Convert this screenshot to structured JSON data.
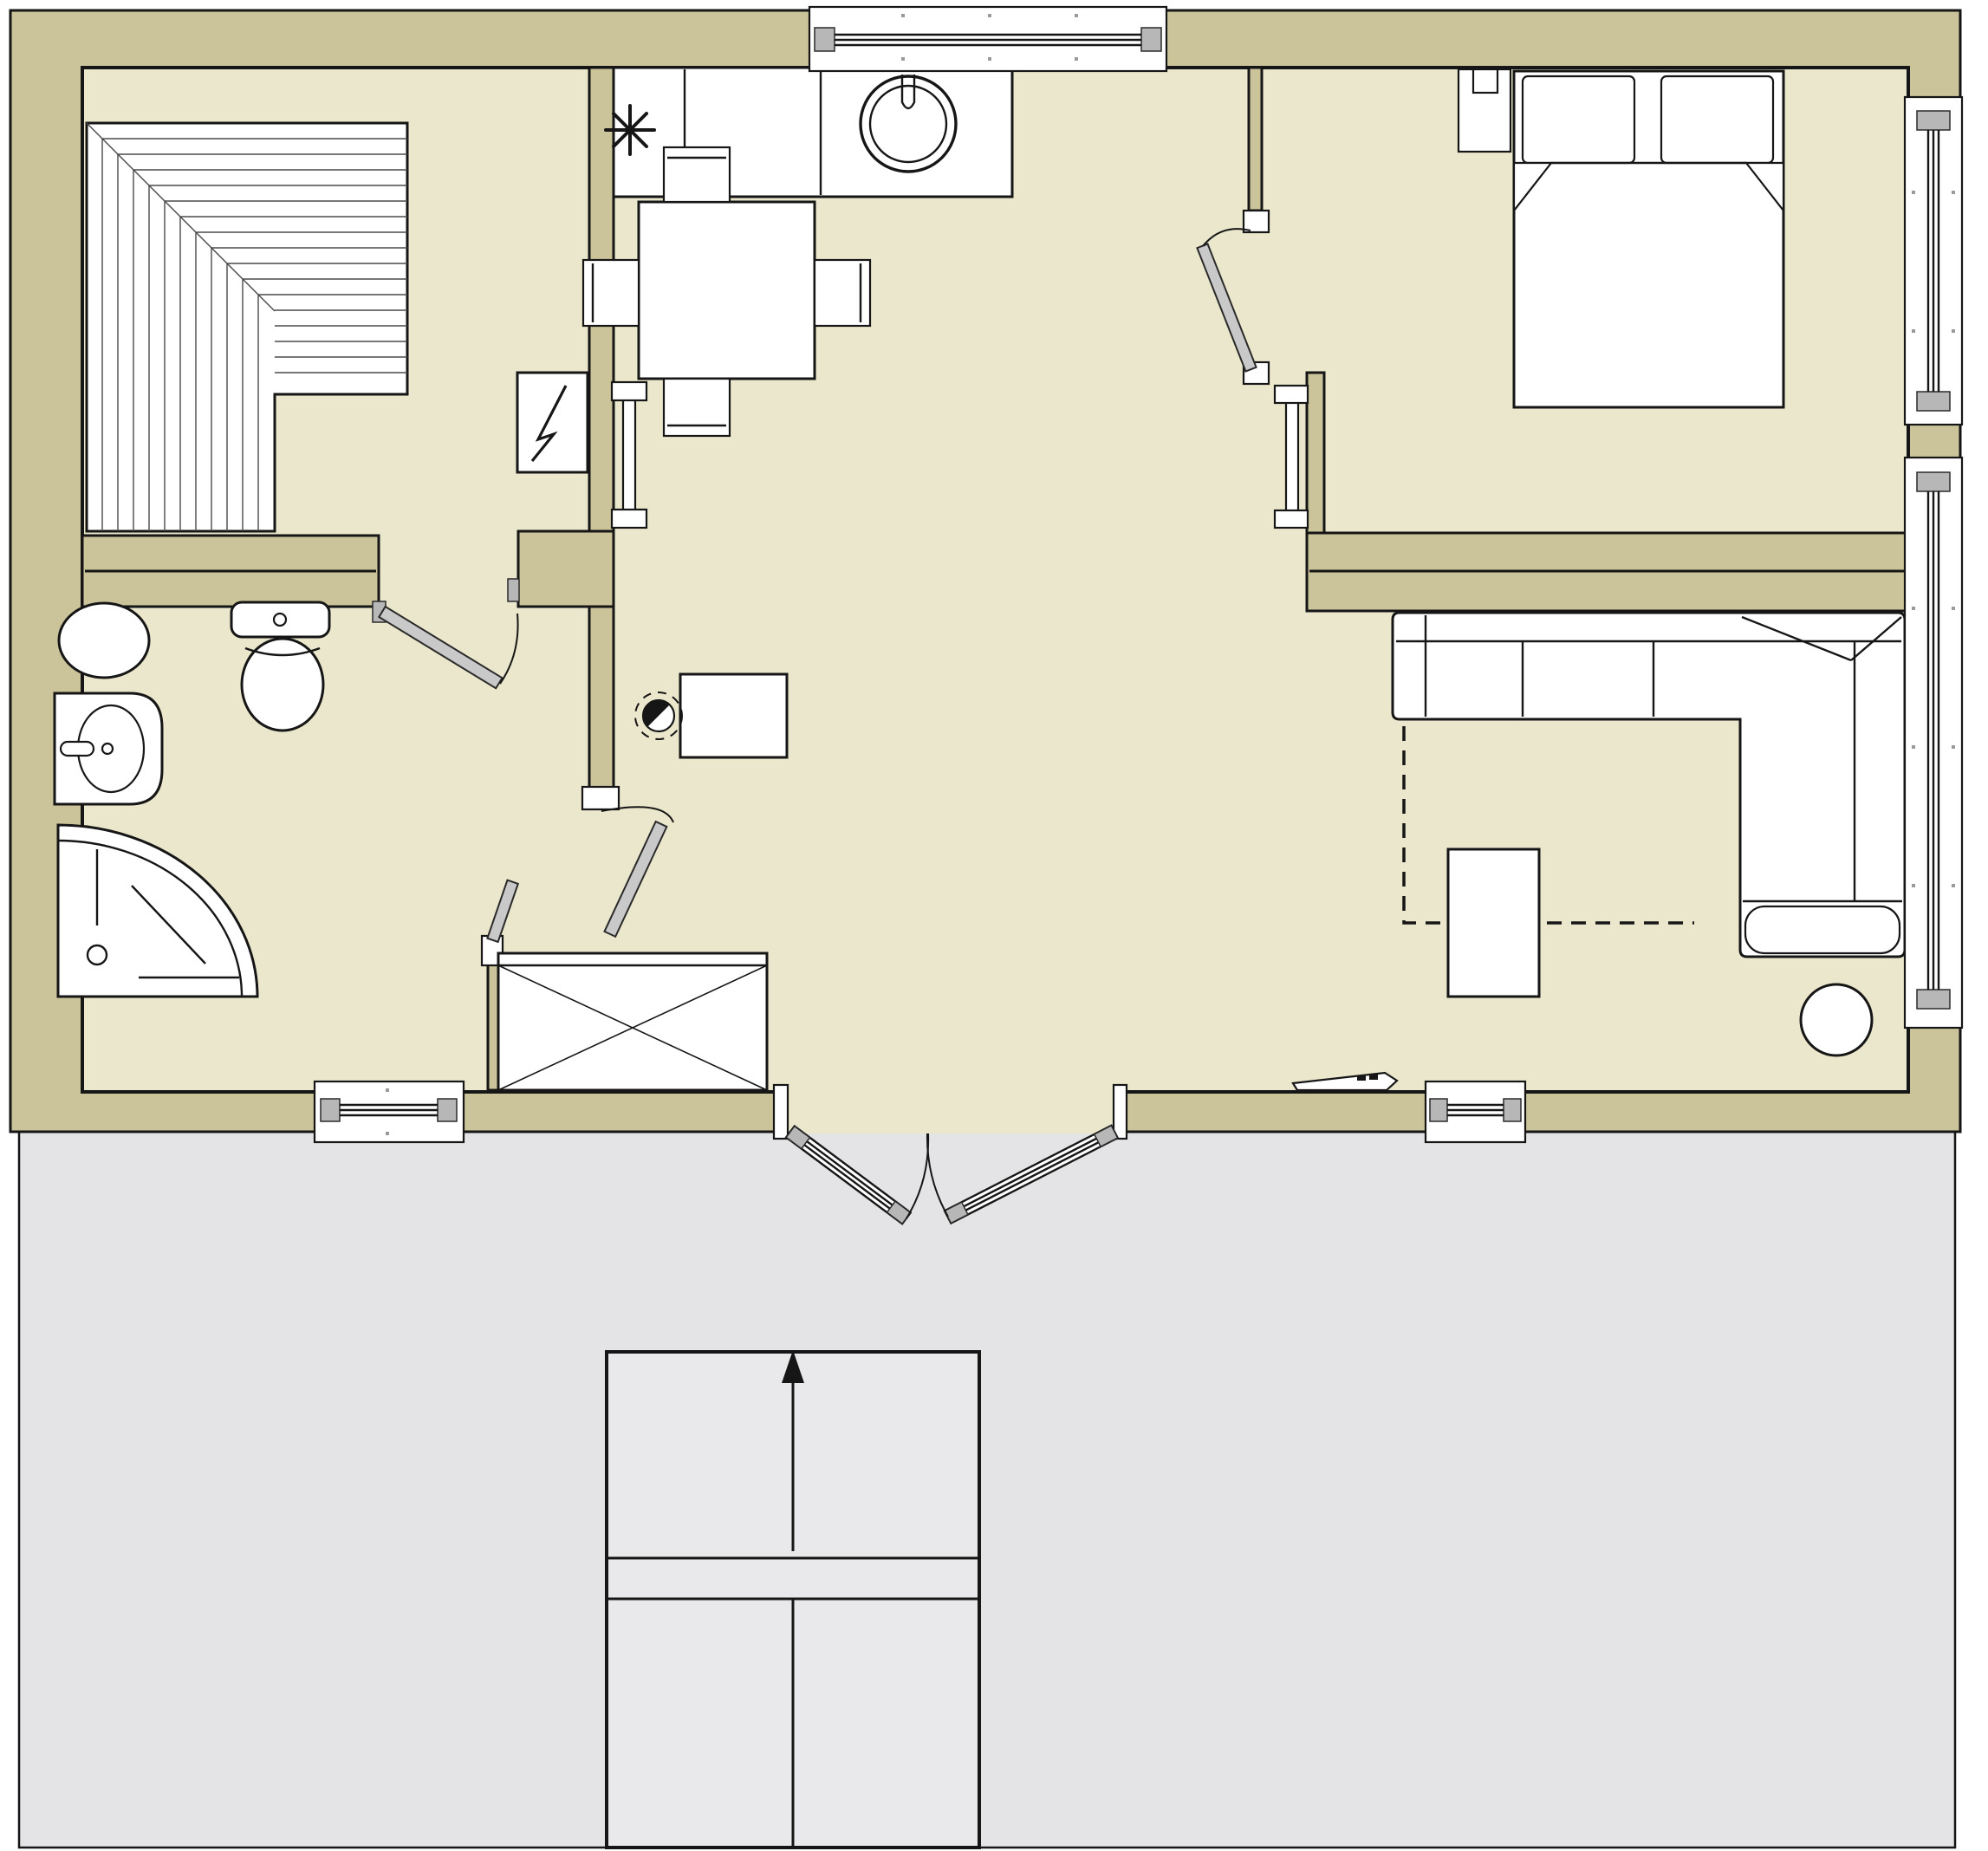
{
  "title": "cabin-floor-plan",
  "colors": {
    "wall": "#cbc39a",
    "floor": "#ebe7cc",
    "deck": "#e4e4e6",
    "line": "#161616",
    "door": "#c9c9c9",
    "hardware": "#b7b7b7"
  },
  "rooms": [
    {
      "name": "sauna",
      "features": [
        "l-shaped-bench",
        "electric-heater",
        "sliding-door"
      ]
    },
    {
      "name": "bathroom",
      "features": [
        "round-basin",
        "toilet",
        "vanity-sink",
        "corner-shower",
        "window"
      ]
    },
    {
      "name": "kitchen-dining",
      "features": [
        "counter",
        "cooktop",
        "round-sink",
        "dining-table",
        "four-chairs",
        "desk",
        "desk-chair",
        "wardrobe"
      ]
    },
    {
      "name": "bedroom",
      "features": [
        "double-bed",
        "two-pillows",
        "nightstand",
        "lamp",
        "window",
        "radiator"
      ]
    },
    {
      "name": "living-room",
      "features": [
        "sectional-sofa",
        "coffee-table",
        "round-stool",
        "rug-outline",
        "media-shelf",
        "window"
      ]
    },
    {
      "name": "deck",
      "features": [
        "entry-steps",
        "up-arrow"
      ]
    }
  ],
  "symbols": {
    "cooktop": "asterisk",
    "heater": "lightning-bolt",
    "entry": "double-french-doors",
    "direction": "arrow-up"
  }
}
